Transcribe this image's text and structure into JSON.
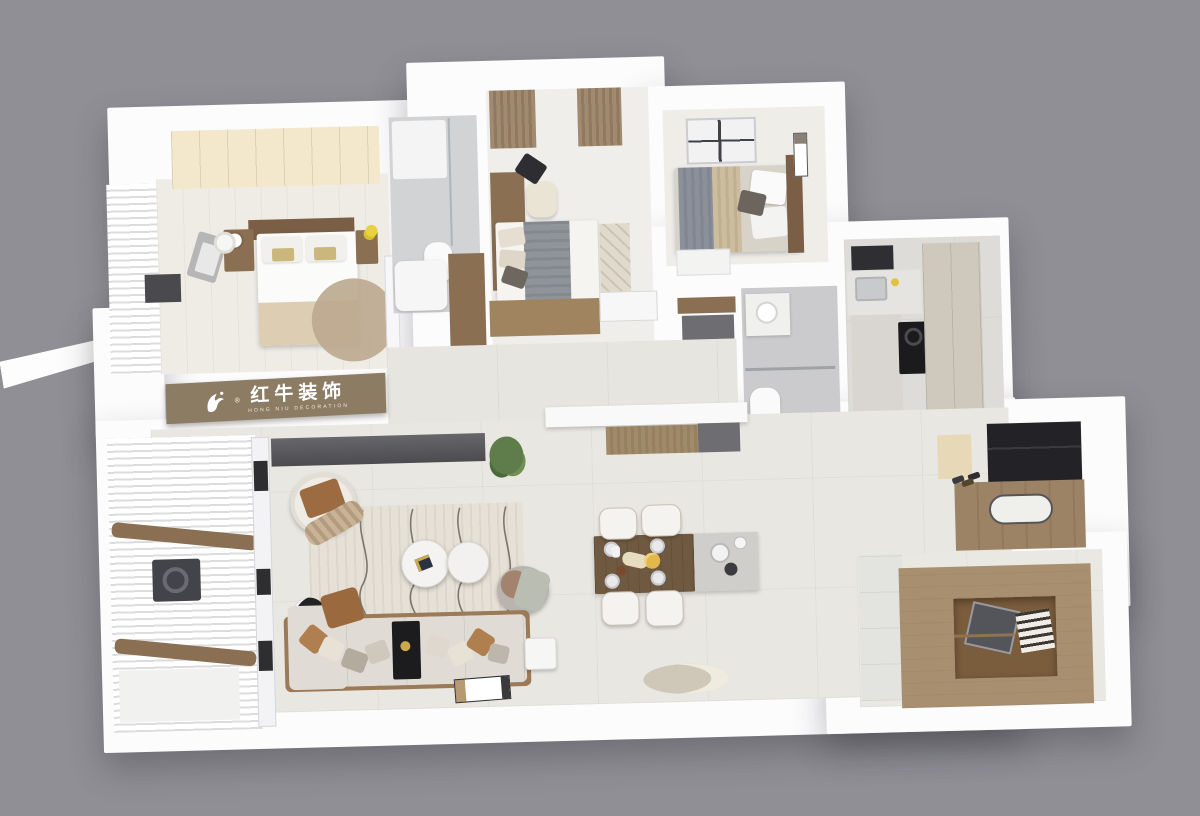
{
  "scene": {
    "description": "3D bird's-eye rendering of a furnished apartment floor plan on a gray backdrop",
    "background_color": "#8f8f95"
  },
  "watermark": {
    "brand_cn": "红牛装饰",
    "brand_en": "HONG NIU DECORATION",
    "registered_mark": "®",
    "band_color": "#8d7c64",
    "text_color": "#ffffff"
  },
  "palette": {
    "wall_white": "#fcfcfd",
    "floor_marble": "#e9e7e2",
    "floor_bedroom": "#efece6",
    "floor_bath": "#cfcfd2",
    "wardrobe_cream": "#f3e8cb",
    "wood_dark": "#7a5f46",
    "wood_mid": "#8a6f52",
    "wood_tan": "#a88f70",
    "entry_floor_brown": "#9d8366",
    "fabric_tan": "#b07f4f",
    "blanket_gray": "#8f939a",
    "tv_dark": "#55555a",
    "unit_black": "#232327",
    "plant_green": "#5e7d4a",
    "gold_accent": "#caa84e",
    "duvet_fold_beige": "#ddcdb3"
  },
  "rooms": {
    "master_bedroom": {
      "furniture": [
        "cream wardrobe",
        "double bed with gold-striped pillows",
        "dark wood headboard",
        "two nightstands",
        "table lamp",
        "round tan rug",
        "gray bench",
        "laundry basket",
        "curtained window bay"
      ]
    },
    "master_bathroom": {
      "furniture": [
        "shower tray",
        "glass partition",
        "toilet",
        "white tub counter"
      ]
    },
    "bedroom_2": {
      "furniture": [
        "bay window with tan curtains",
        "desk",
        "cream chair",
        "bed with gray blanket",
        "patterned runner rug",
        "wood low cabinet",
        "window sill"
      ]
    },
    "bedroom_3": {
      "furniture": [
        "striped duvet bed",
        "dark wood headboard",
        "white pillows",
        "dark accent pillow",
        "ceiling window grid",
        "wall art",
        "white dresser"
      ]
    },
    "bathroom_2": {
      "furniture": [
        "vanity cabinet",
        "glass shower divider",
        "toilet"
      ]
    },
    "kitchen": {
      "furniture": [
        "range hood",
        "sink counter",
        "L-shaped counter",
        "black cooktop",
        "beige tall cabinets"
      ]
    },
    "hallway": {
      "furniture": [
        "brown closet",
        "wall console with brown and gray panels"
      ]
    },
    "living_room": {
      "furniture": [
        "TV on media wall",
        "corner plant",
        "accent armchair with brown pillow",
        "wavy-pattern rug",
        "two round marble coffee tables",
        "black floor lamp",
        "long beige sofa with pillows",
        "black console divider",
        "side table",
        "leaning floor artwork",
        "sage throw armchair"
      ]
    },
    "dining_area": {
      "furniture": [
        "dark wood dining table",
        "four white chairs",
        "place settings with navy napkins",
        "glass sideboard with plates",
        "round floor rug"
      ]
    },
    "balcony": {
      "furniture": [
        "white blinds",
        "wood shelves",
        "washing machine",
        "lower cabinet",
        "glass partition door"
      ]
    },
    "entry": {
      "furniture": [
        "black shoe cabinet",
        "cream cabinet",
        "brown plank floor",
        "white oval mat",
        "shoes"
      ]
    },
    "study": {
      "furniture": [
        "tan platform desk unit",
        "open shelf with books",
        "monitor",
        "white cabinet column"
      ]
    }
  }
}
